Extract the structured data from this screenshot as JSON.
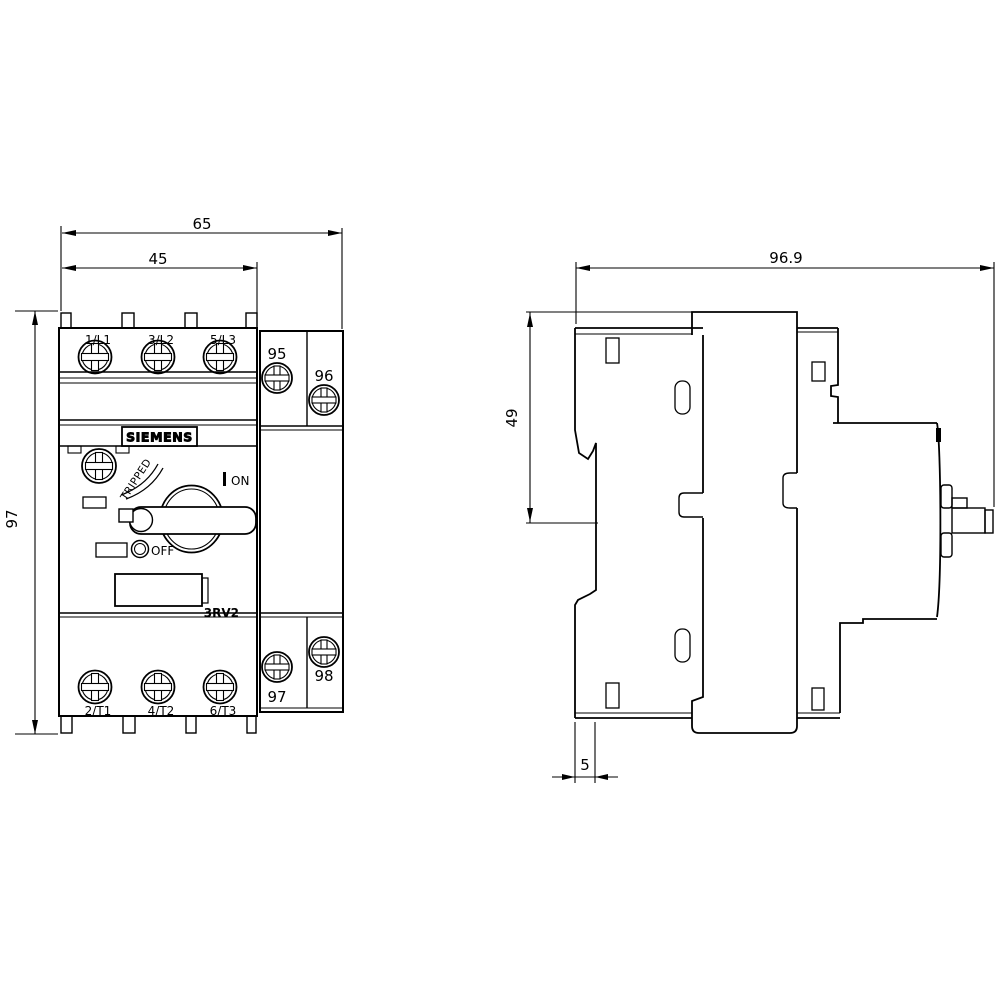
{
  "front_view": {
    "dims": {
      "total_width": "65",
      "body_width": "45",
      "height": "97"
    },
    "terminals_top": [
      "1/L1",
      "3/L2",
      "5/L3"
    ],
    "terminals_bottom": [
      "2/T1",
      "4/T2",
      "6/T3"
    ],
    "aux_terminals": {
      "t95": "95",
      "t96": "96",
      "t97": "97",
      "t98": "98"
    },
    "brand": "SIEMENS",
    "series_label": "3RV2",
    "switch": {
      "on": "ON",
      "off": "OFF",
      "tripped": "TRIPPED"
    }
  },
  "side_view": {
    "dims": {
      "total_depth": "96.9",
      "back_depth": "49",
      "rail_width": "5"
    }
  }
}
